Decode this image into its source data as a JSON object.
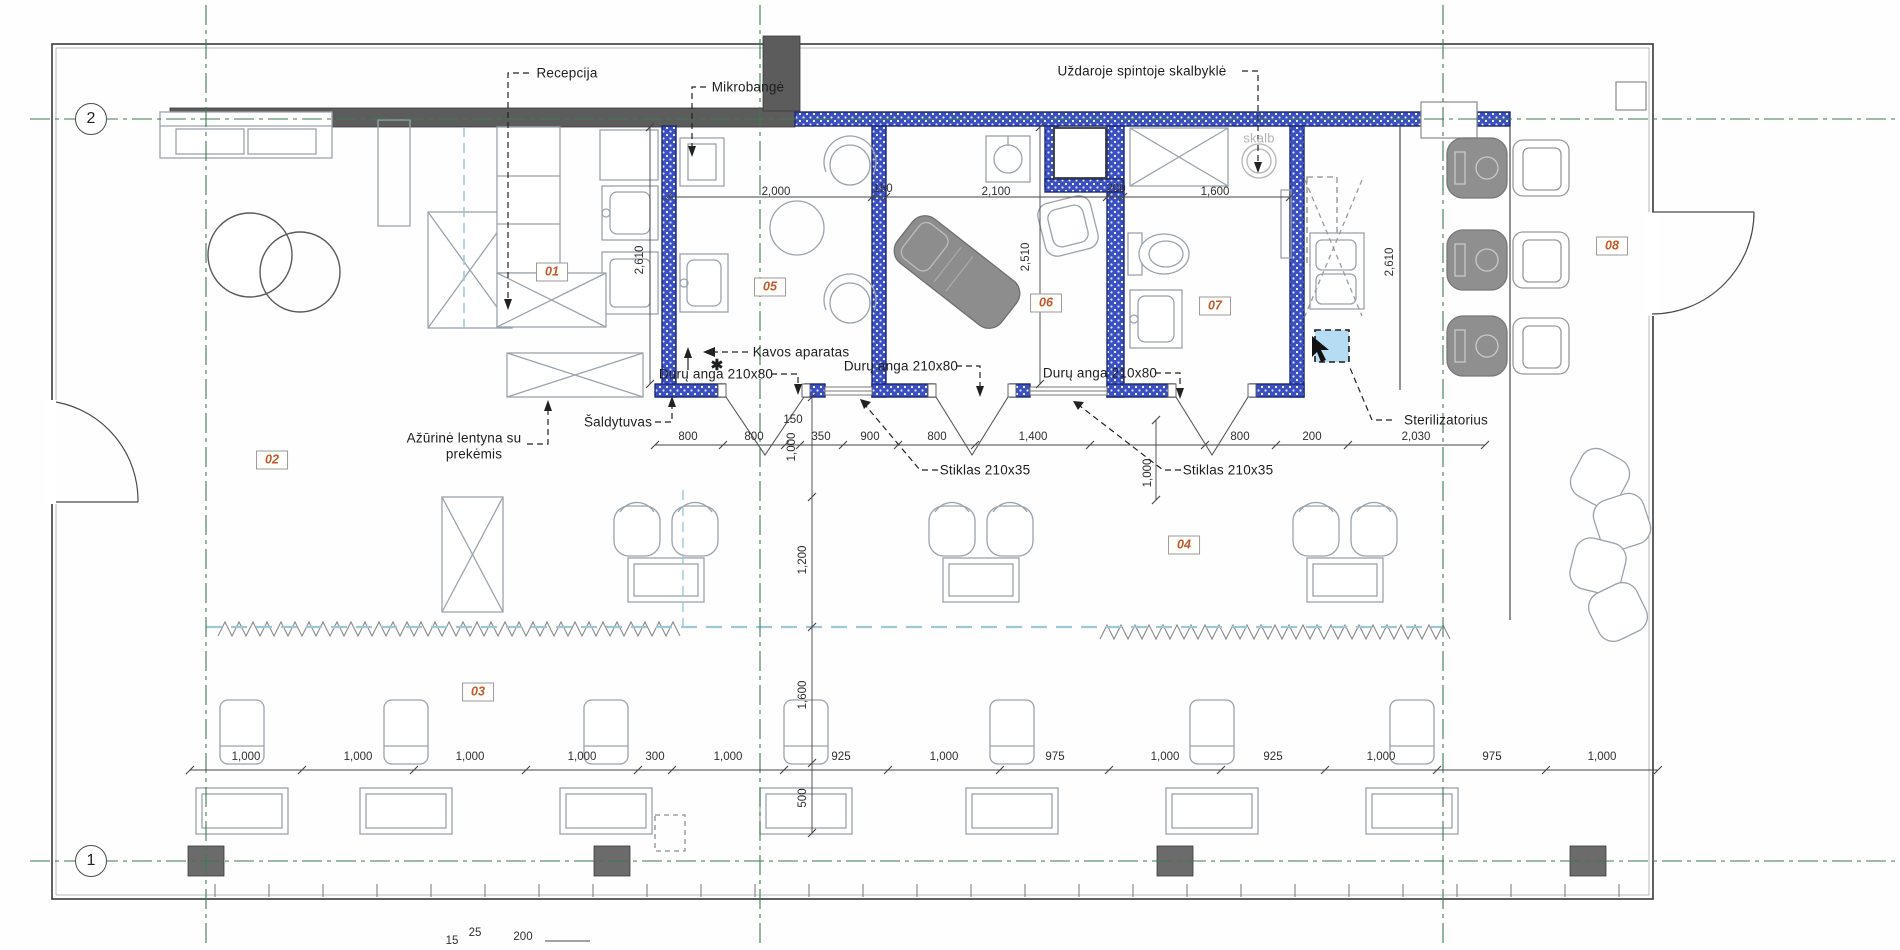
{
  "drawing_title": "Salono planas",
  "colors": {
    "wall_blue": "#3b4fc0",
    "wall_blue_border": "#1b2a78",
    "wall_dark": "#5c5c5c",
    "grid_green": "#3c7b52",
    "teal_dashed": "#9ec7d6",
    "tag_text": "#c05a2e",
    "sterilizer_fill": "#b5dcf2"
  },
  "grid_bubbles": [
    {
      "label": "2",
      "x": 91,
      "y": 119
    },
    {
      "label": "1",
      "x": 91,
      "y": 861
    }
  ],
  "room_tags": [
    {
      "num": "01",
      "x": 552,
      "y": 272
    },
    {
      "num": "02",
      "x": 272,
      "y": 460
    },
    {
      "num": "03",
      "x": 478,
      "y": 692
    },
    {
      "num": "04",
      "x": 1184,
      "y": 545
    },
    {
      "num": "05",
      "x": 770,
      "y": 287
    },
    {
      "num": "06",
      "x": 1046,
      "y": 303
    },
    {
      "num": "07",
      "x": 1215,
      "y": 306
    },
    {
      "num": "08",
      "x": 1612,
      "y": 246
    }
  ],
  "annotations": [
    {
      "id": "recepcija",
      "text": "Recepcija",
      "x": 567,
      "y": 73
    },
    {
      "id": "mikrobange",
      "text": "Mikrobangė",
      "x": 748,
      "y": 87
    },
    {
      "id": "uzdaroje-spintoje-skalbykle",
      "text": "Uždaroje spintoje skalbyklė",
      "x": 1142,
      "y": 71
    },
    {
      "id": "kavos-aparatas",
      "text": "Kavos aparatas",
      "x": 801,
      "y": 352
    },
    {
      "id": "duru-anga-1",
      "text": "Durų anga 210x80",
      "x": 716,
      "y": 374
    },
    {
      "id": "duru-anga-2",
      "text": "Durų anga 210x80",
      "x": 901,
      "y": 366
    },
    {
      "id": "duru-anga-3",
      "text": "Durų anga 210x80",
      "x": 1100,
      "y": 373
    },
    {
      "id": "saldytuvas",
      "text": "Šaldytuvas",
      "x": 618,
      "y": 422
    },
    {
      "id": "azurine-lentyna-1",
      "text": "Ažūrinė lentyna su",
      "x": 464,
      "y": 438
    },
    {
      "id": "azurine-lentyna-2",
      "text": "prekėmis",
      "x": 474,
      "y": 454
    },
    {
      "id": "stiklas-1",
      "text": "Stiklas 210x35",
      "x": 985,
      "y": 470
    },
    {
      "id": "stiklas-2",
      "text": "Stiklas 210x35",
      "x": 1228,
      "y": 470
    },
    {
      "id": "sterilizatorius",
      "text": "Sterilizatorius",
      "x": 1446,
      "y": 420
    },
    {
      "id": "skalb",
      "text": "skalb",
      "x": 1259,
      "y": 138,
      "muted": true
    },
    {
      "id": "asterisk",
      "text": "✱",
      "x": 717,
      "y": 365,
      "sym": true
    }
  ],
  "dimensions": [
    {
      "text": "2,000",
      "x": 776,
      "y": 192
    },
    {
      "text": "150",
      "x": 883,
      "y": 189
    },
    {
      "text": "2,100",
      "x": 996,
      "y": 192
    },
    {
      "text": "200",
      "x": 1116,
      "y": 189
    },
    {
      "text": "1,600",
      "x": 1215,
      "y": 192
    },
    {
      "text": "2,610",
      "x": 640,
      "y": 260,
      "rot": true
    },
    {
      "text": "2,510",
      "x": 1026,
      "y": 257,
      "rot": true
    },
    {
      "text": "2,610",
      "x": 1390,
      "y": 262,
      "rot": true
    },
    {
      "text": "800",
      "x": 688,
      "y": 437
    },
    {
      "text": "800",
      "x": 754,
      "y": 437
    },
    {
      "text": "150",
      "x": 793,
      "y": 420
    },
    {
      "text": "350",
      "x": 821,
      "y": 437
    },
    {
      "text": "900",
      "x": 870,
      "y": 437
    },
    {
      "text": "800",
      "x": 937,
      "y": 437
    },
    {
      "text": "1,400",
      "x": 1033,
      "y": 437
    },
    {
      "text": "800",
      "x": 1240,
      "y": 437
    },
    {
      "text": "200",
      "x": 1312,
      "y": 437
    },
    {
      "text": "2,030",
      "x": 1416,
      "y": 437
    },
    {
      "text": "1,000",
      "x": 792,
      "y": 447,
      "rot": true
    },
    {
      "text": "1,000",
      "x": 1148,
      "y": 473,
      "rot": true
    },
    {
      "text": "1,200",
      "x": 803,
      "y": 560,
      "rot": true
    },
    {
      "text": "1,600",
      "x": 803,
      "y": 695,
      "rot": true
    },
    {
      "text": "500",
      "x": 803,
      "y": 798,
      "rot": true
    },
    {
      "text": "1,000",
      "x": 246,
      "y": 757
    },
    {
      "text": "1,000",
      "x": 358,
      "y": 757
    },
    {
      "text": "1,000",
      "x": 470,
      "y": 757
    },
    {
      "text": "1,000",
      "x": 582,
      "y": 757
    },
    {
      "text": "300",
      "x": 655,
      "y": 757
    },
    {
      "text": "1,000",
      "x": 728,
      "y": 757
    },
    {
      "text": "925",
      "x": 841,
      "y": 757
    },
    {
      "text": "1,000",
      "x": 944,
      "y": 757
    },
    {
      "text": "975",
      "x": 1055,
      "y": 757
    },
    {
      "text": "1,000",
      "x": 1165,
      "y": 757
    },
    {
      "text": "925",
      "x": 1273,
      "y": 757
    },
    {
      "text": "1,000",
      "x": 1381,
      "y": 757
    },
    {
      "text": "975",
      "x": 1492,
      "y": 757
    },
    {
      "text": "1,000",
      "x": 1602,
      "y": 757
    },
    {
      "text": "15",
      "x": 452,
      "y": 941
    },
    {
      "text": "25",
      "x": 475,
      "y": 933
    },
    {
      "text": "200",
      "x": 523,
      "y": 937
    }
  ]
}
